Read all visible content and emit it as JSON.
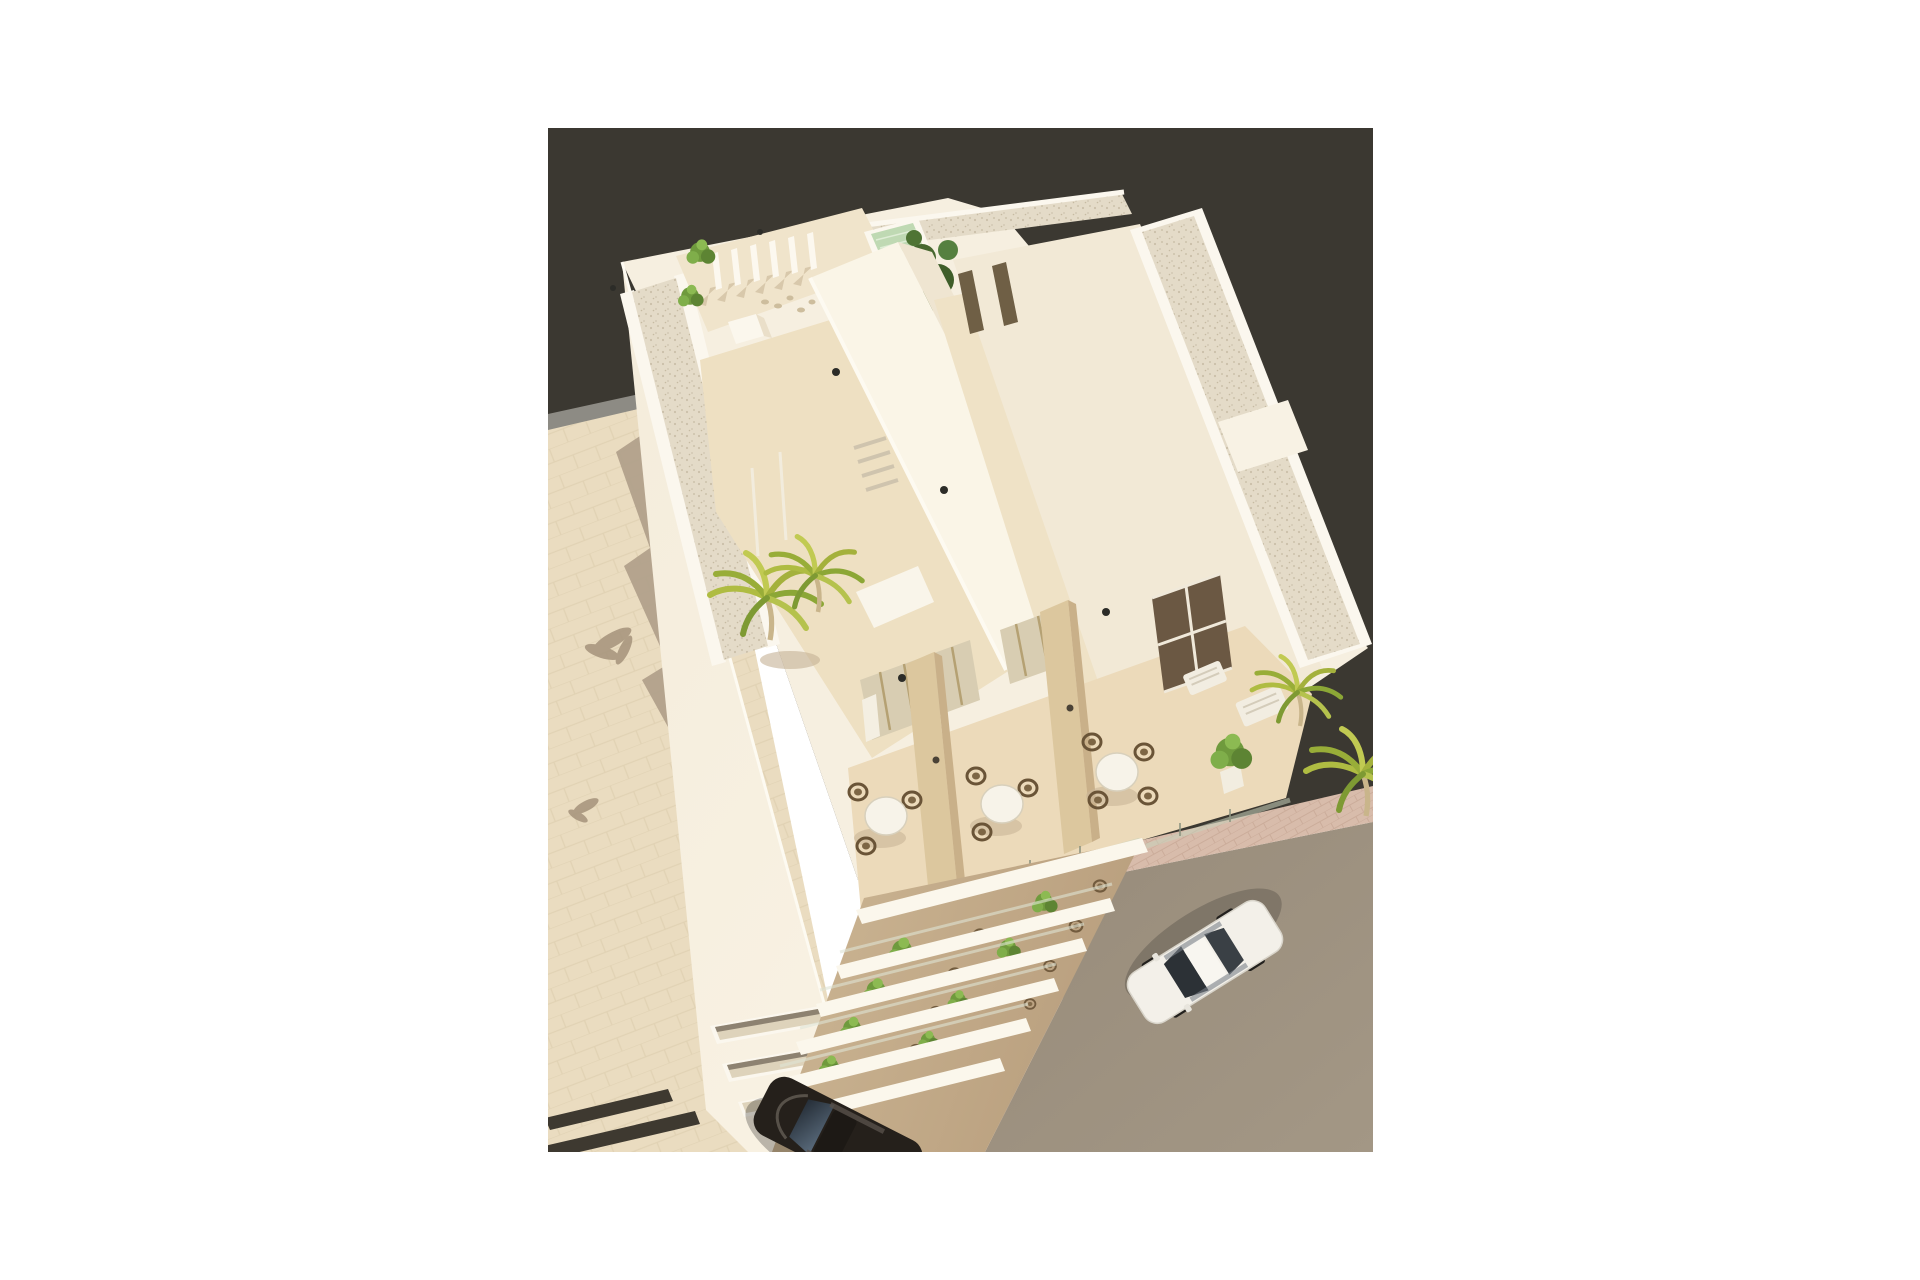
{
  "scene": {
    "kind": "aerial-3d-architectural-render",
    "description": "Bird's-eye 3D rendering of a modern white corner apartment building with rooftop terraces, a small plunge pool, pergola, palm trees, three terrace seating bays with round tables, four stacked balcony levels, beige paved plaza with crosswalk stripes, and a street corner with a parked white car and a dark car",
    "counts": {
      "balcony_levels": 4,
      "terrace_tables": 3,
      "privacy_dividers": 2,
      "cars": 2,
      "sun_loungers": 2,
      "crosswalk_stripes": 2,
      "ground_floor_vents": 3,
      "rooftop_pools": 1
    },
    "labels": {
      "sky": "backdrop",
      "building": "white apartment building",
      "pool": "rooftop plunge pool",
      "pergola": "rooftop pergola fins",
      "terrace": "terrace with tables",
      "balconies": "stacked balconies",
      "white_car": "white parked car",
      "dark_car": "dark car",
      "road": "street",
      "plaza": "paved plaza"
    }
  },
  "palette": {
    "margin": "#ffffff",
    "sky": "#3b3831",
    "wall": "#f6efe0",
    "wall_bright": "#faf5e7",
    "wall_shade": "#efe5d1",
    "wall_warm": "#f2e9d6",
    "gravel": "#e4dbc8",
    "floor": "#eddfc1",
    "pavement": "#eadcc0",
    "pavement_shadow": "#b2a18b",
    "strip_gray": "#8d8b84",
    "road": "#9c9080",
    "sidewalk_pink": "#d8bcab",
    "apron_pink": "#d9c0ae",
    "divider": "#dcc79e",
    "door_dark": "#6b5843",
    "glass": "#d8cdb2",
    "plant": "#6f9a3d",
    "plant_dark": "#4a6b2f",
    "palm": "#afbc42",
    "pool": "#bfd9b3",
    "chair": "#6a5437",
    "crosswalk": "#3e3930",
    "car_white": "#f3f0e9",
    "car_dark": "#25201b",
    "windshield": "#2c3136"
  }
}
